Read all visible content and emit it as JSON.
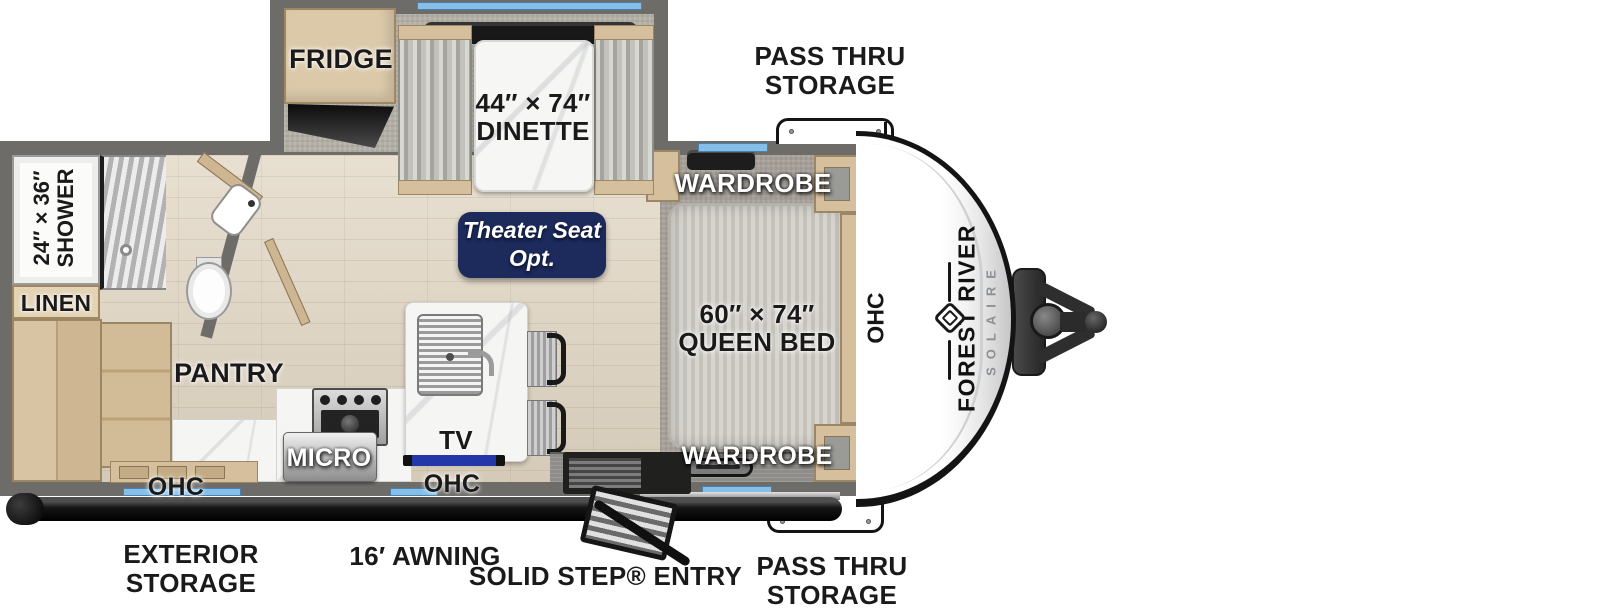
{
  "title": "Forest River Solaire travel trailer floorplan",
  "colors": {
    "badge_navy": "#1c2a5c",
    "window_blue": "#85bfe8",
    "tv_blue": "#2337a8",
    "wall_gray": "#6e6c69"
  },
  "brand": {
    "primary": "FOREST RIVER",
    "secondary": "SOLAIRE"
  },
  "badge": {
    "line1": "Theater Seat",
    "line2": "Opt."
  },
  "rooms": {
    "fridge": "FRIDGE",
    "dinette_size": "44″ × 74″",
    "dinette_name": "DINETTE",
    "queen_size": "60″ × 74″",
    "queen_name": "QUEEN BED",
    "shower_size": "24″ × 36″",
    "shower_name": "SHOWER",
    "linen": "LINEN",
    "pantry": "PANTRY",
    "micro": "MICRO",
    "tv": "TV",
    "wardrobe_top": "WARDROBE",
    "wardrobe_bottom": "WARDROBE",
    "ohc_kitchen_left": "OHC",
    "ohc_kitchen_right": "OHC",
    "ohc_front_cap": "OHC"
  },
  "exterior": {
    "pass_thru_top_line1": "PASS THRU",
    "pass_thru_top_line2": "STORAGE",
    "pass_thru_bottom_line1": "PASS THRU",
    "pass_thru_bottom_line2": "STORAGE",
    "exterior_storage_line1": "EXTERIOR",
    "exterior_storage_line2": "STORAGE",
    "awning": "16′ AWNING",
    "entry": "SOLID STEP® ENTRY"
  }
}
